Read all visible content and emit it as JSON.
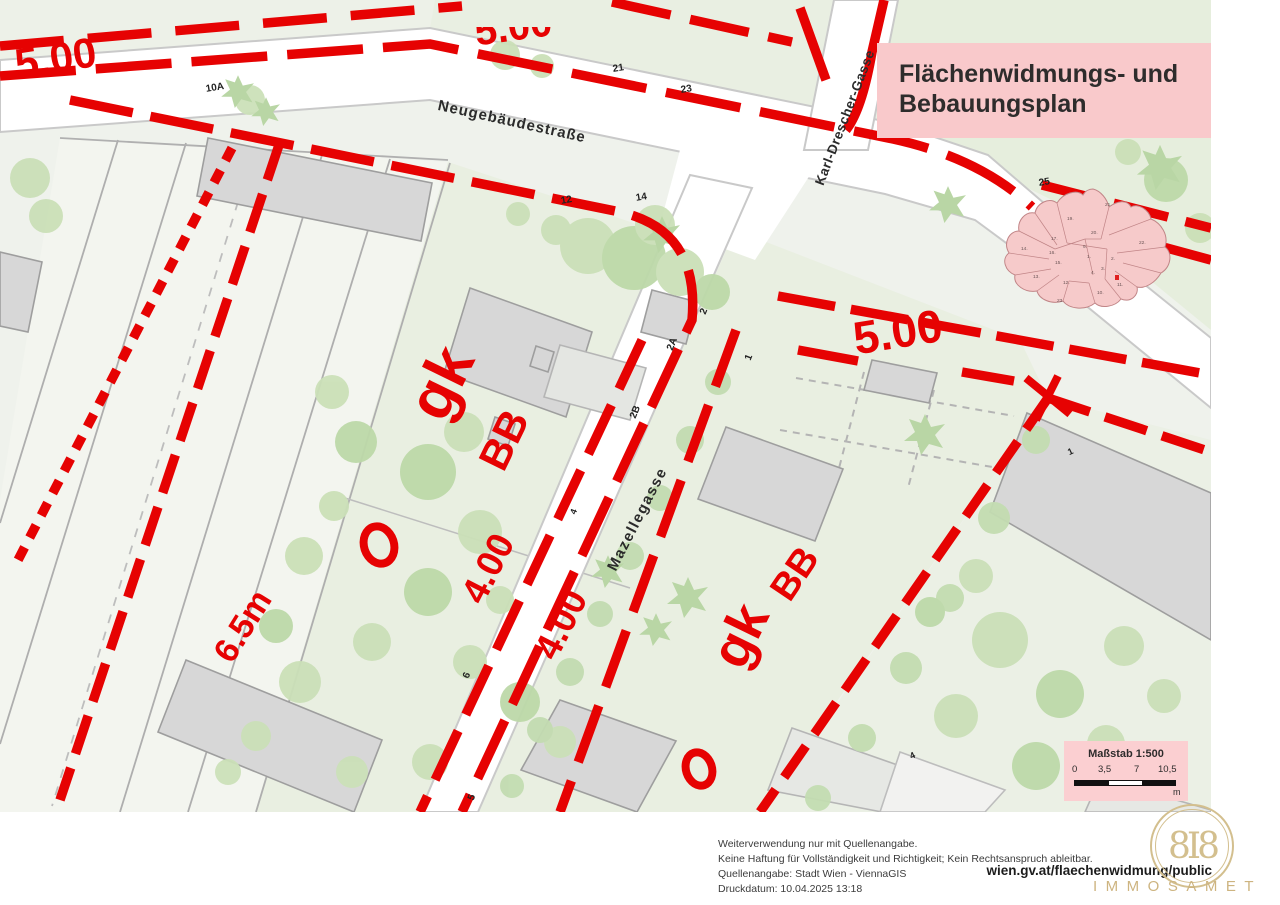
{
  "colors": {
    "red": "#e60202",
    "pink": "#f9c9cb",
    "map_bg": "#eff2ec",
    "gold": "#cdb480"
  },
  "title_box": {
    "line1": "Flächenwidmungs- und",
    "line2": "Bebauungsplan"
  },
  "streets": {
    "neugebaeudestrasse": "Neugebäudestraße",
    "karl_drescher_gasse": "Karl-Drescher-Gasse",
    "mazellegasse": "Mazellegasse"
  },
  "zoning": {
    "w5_topleft": "5.00",
    "w5_topcenter": "5.00",
    "w5_right": "5.00",
    "w4_west": "4.00",
    "w4_east": "4.00",
    "h_65": "6.5m",
    "gk_left": "gk",
    "bb_left": "BB",
    "gk_right": "gk",
    "bb_right": "BB"
  },
  "house_numbers": {
    "h10a": "10A",
    "h21": "21",
    "h23": "23",
    "h25": "25",
    "h12": "12",
    "h14": "14",
    "h2": "2",
    "h2a": "2A",
    "h1": "1",
    "h2b": "2B",
    "h4": "4",
    "h6": "6",
    "h5": "5",
    "h1_right": "1",
    "h4_right": "4"
  },
  "mini_map": {
    "districts": [
      {
        "label": "21."
      },
      {
        "label": "19."
      },
      {
        "label": "20."
      },
      {
        "label": "22."
      },
      {
        "label": "9."
      },
      {
        "label": "17."
      },
      {
        "label": "14."
      },
      {
        "label": "16."
      },
      {
        "label": "15."
      },
      {
        "label": "1."
      },
      {
        "label": "2."
      },
      {
        "label": "3."
      },
      {
        "label": "4."
      },
      {
        "label": "13."
      },
      {
        "label": "12."
      },
      {
        "label": "10."
      },
      {
        "label": "11."
      },
      {
        "label": "23."
      }
    ]
  },
  "scale_box": {
    "title": "Maßstab 1:500",
    "ticks": [
      {
        "t": "0"
      },
      {
        "t": "3,5"
      },
      {
        "t": "7"
      },
      {
        "t": "10,5"
      }
    ],
    "unit": "m"
  },
  "footer": {
    "line1": "Weiterverwendung nur mit Quellenangabe.",
    "line2": "Keine Haftung für Vollständigkeit und Richtigkeit; Kein Rechtsanspruch ableitbar.",
    "line3": "Quellenangabe: Stadt Wien - ViennaGIS",
    "line4": "Druckdatum: 10.04.2025 13:18",
    "url": "wien.gv.at/flaechenwidmung/public"
  },
  "watermark": {
    "text": "IMMOSAMET",
    "monogram": "8I8"
  }
}
